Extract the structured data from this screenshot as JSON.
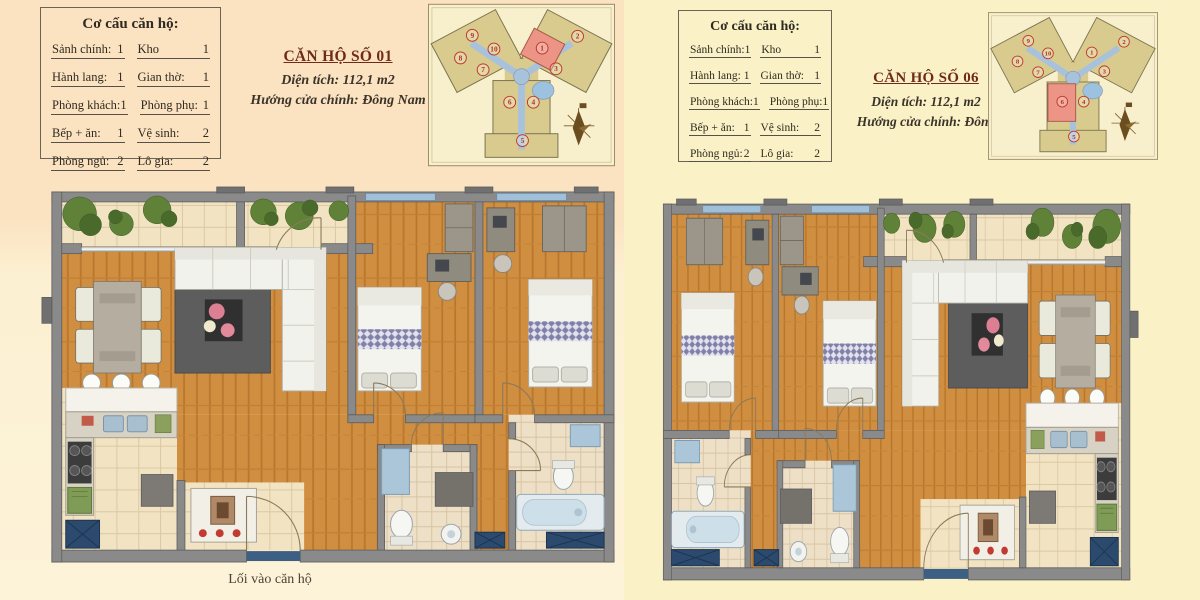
{
  "shared": {
    "table": {
      "title": "Cơ cấu căn hộ:",
      "rows": [
        {
          "l": "Sảnh chính:",
          "lv": "1",
          "r": "Kho",
          "rv": "1"
        },
        {
          "l": "Hành lang:",
          "lv": "1",
          "r": "Gian thờ:",
          "rv": "1"
        },
        {
          "l": "Phòng khách:",
          "lv": "1",
          "r": "Phòng phụ:",
          "rv": "1"
        },
        {
          "l": "Bếp + ăn:",
          "lv": "1",
          "r": "Vệ sinh:",
          "rv": "2"
        },
        {
          "l": "Phòng ngủ:",
          "lv": "2",
          "r": "Lô gia:",
          "rv": "2"
        }
      ]
    },
    "keyplan_units": [
      "1",
      "2",
      "3",
      "4",
      "5",
      "6",
      "7",
      "8",
      "9",
      "10"
    ]
  },
  "left_panel": {
    "title": "CĂN HỘ SỐ 01",
    "area": "Diện tích: 112,1 m2",
    "direction": "Hướng cửa chính: Đông Nam",
    "entrance_label": "Lối vào căn hộ",
    "keyplan_highlighted_unit": "1"
  },
  "right_panel": {
    "title": "CĂN HỘ SỐ 06",
    "area": "Diện tích: 112,1 m2",
    "direction": "Hướng cửa chính: Đông",
    "keyplan_highlighted_unit": "6"
  },
  "icons": {
    "compass": "north-arrow-compass",
    "tree": "plant-canopy",
    "stove": "four-burner-cooktop",
    "shoe_cabinet": "entry-shoe-cabinet"
  },
  "colors": {
    "left_bg_top": "#fbe2c0",
    "left_bg_bottom": "#fdf3d8",
    "right_bg": "#faf2c6",
    "apartment_title": "#6e2a1a",
    "body_text": "#2f2a22",
    "wall_gray": "#8a8a8a",
    "wood_floor": "#d08e41",
    "tile_floor": "#f2e4c2",
    "keyplan_building": "#d9cb8d",
    "keyplan_corridor": "#a9c2dc",
    "keyplan_highlight": "#ec9486",
    "unit_number": "#b03226",
    "shaft_blue": "#2b4a6d",
    "tree_green": "#5f8138"
  }
}
